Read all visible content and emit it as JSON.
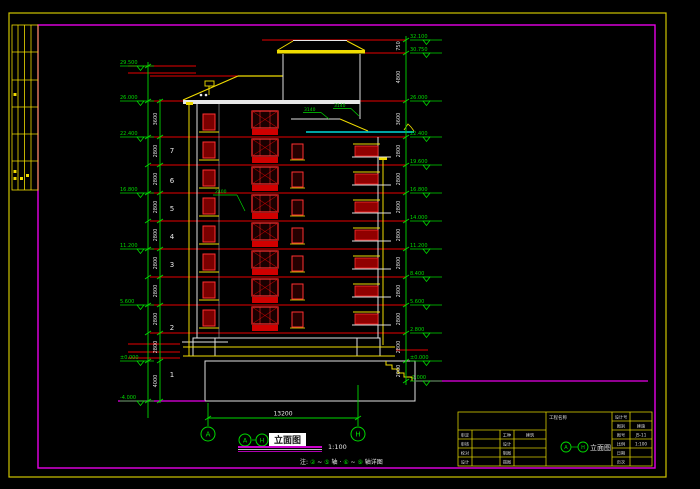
{
  "colors": {
    "red": "#e80000",
    "red_bright": "#ff3030",
    "yellow": "#f0dc00",
    "green": "#00d800",
    "magenta": "#e800e8",
    "white": "#e8e8e8",
    "cyan": "#00d8d8"
  },
  "drawing": {
    "floor_labels": [
      "7",
      "6",
      "5",
      "4",
      "3",
      "2",
      "1"
    ],
    "slope_label_1": "3140",
    "slope_label_2": "3140",
    "leader_label": "2400"
  },
  "dims": {
    "left_elevations": [
      "29.500",
      "26.000",
      "22.400",
      "16.800",
      "11.200",
      "5.600",
      "±0.000",
      "-4.000"
    ],
    "left_storey": [
      "3600",
      "2800",
      "2800",
      "2800",
      "2800",
      "2800",
      "2800",
      "2800",
      "2800",
      "4000"
    ],
    "right_elevations": [
      "32.100",
      "30.750",
      "26.000",
      "22.400",
      "19.600",
      "16.800",
      "14.000",
      "11.200",
      "8.400",
      "5.600",
      "2.800",
      "±0.000",
      "-2.000"
    ],
    "right_storey": [
      "750",
      "4800",
      "3600",
      "2800",
      "2800",
      "2800",
      "2800",
      "2800",
      "2800",
      "2800",
      "2800",
      "2000"
    ],
    "span": "13200",
    "grid_left": "A",
    "grid_right": "H"
  },
  "title": {
    "axis_from": "A",
    "axis_to": "H",
    "name": "立面图",
    "scale": "1:100"
  },
  "note": {
    "segments": [
      {
        "t": "注:",
        "g": 0
      },
      {
        "t": "②",
        "g": 1
      },
      {
        "t": "~",
        "g": 0
      },
      {
        "t": "⑤",
        "g": 1
      },
      {
        "t": "轴",
        "g": 0
      },
      {
        "t": "·",
        "g": 0
      },
      {
        "t": "⑥",
        "g": 1
      },
      {
        "t": "~",
        "g": 0
      },
      {
        "t": "⑨",
        "g": 1
      },
      {
        "t": "轴详图",
        "g": 0
      }
    ]
  },
  "title_block": {
    "project_label": "工程名称",
    "drawing_name": "立面图",
    "rows_left": [
      {
        "label": "审定",
        "value": ""
      },
      {
        "label": "审核",
        "value": ""
      },
      {
        "label": "校对",
        "value": ""
      },
      {
        "label": "设计",
        "value": ""
      }
    ],
    "rows_mid": [
      {
        "label": "工种",
        "value": "建筑"
      },
      {
        "label": "设计",
        "value": ""
      },
      {
        "label": "制图",
        "value": ""
      },
      {
        "label": "描图",
        "value": ""
      }
    ],
    "rows_right": [
      {
        "label": "设计号",
        "value": ""
      },
      {
        "label": "图别",
        "value": "建施"
      },
      {
        "label": "图号",
        "value": "JS-11"
      },
      {
        "label": "比例",
        "value": "1:100"
      },
      {
        "label": "日期",
        "value": ""
      },
      {
        "label": "页次",
        "value": ""
      }
    ]
  }
}
